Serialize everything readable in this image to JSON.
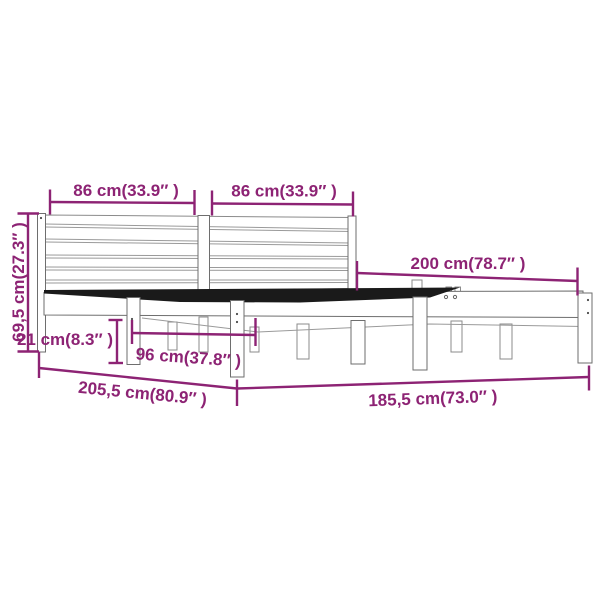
{
  "diagram": {
    "description": "Bed frame dimension line drawing with magenta measurement annotations",
    "accent_color": "#8d2374",
    "background_color": "#ffffff",
    "labels": {
      "headboard_left_width": "86 cm(33.9″ )",
      "headboard_right_width": "86 cm(33.9″ )",
      "inner_length": "200 cm(78.7″ )",
      "headboard_height": "69,5 cm(27.3″ )",
      "under_bed_clearance": "21 cm(8.3″ )",
      "leg_spacing": "96 cm(37.8″ )",
      "total_length": "205,5 cm(80.9″ )",
      "total_width": "185,5 cm(73.0″ )"
    }
  }
}
